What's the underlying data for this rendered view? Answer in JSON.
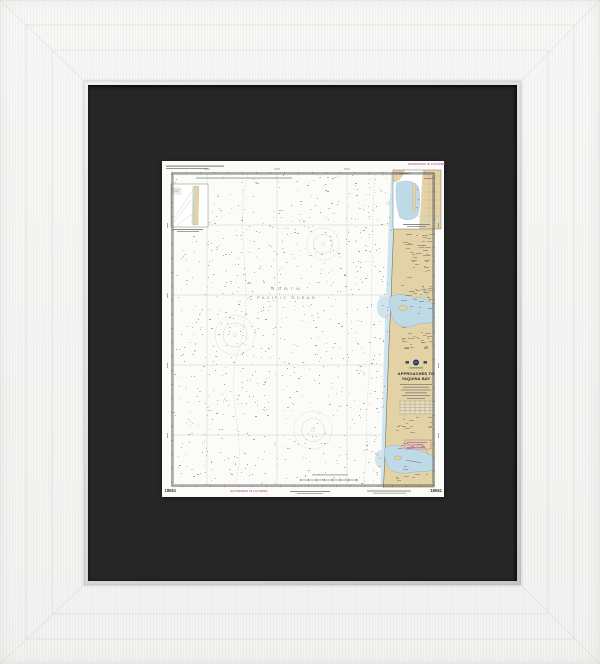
{
  "artwork": {
    "kind": "framed nautical chart print",
    "frame": {
      "color": "#f6f6f5",
      "mat_color": "#262627",
      "lip_light": "#f0f0ef",
      "lip_dark": "#c5c5c3"
    },
    "chart": {
      "number": "18561",
      "title_lines": [
        "APPROACHES TO",
        "YAQUINA BAY"
      ],
      "ocean_label_lines": [
        "NORTH",
        "PACIFIC OCEAN"
      ],
      "soundings_label": "SOUNDINGS IN FATHOMS",
      "colors": {
        "paper": "#fbfbf8",
        "land": "#e2d2a6",
        "shallow_water": "#cde3ec",
        "bay_water": "#bedae6",
        "magenta": "#b95f9e",
        "sounding_dot": "#8f93a0",
        "neatline": "#4c4c4a"
      },
      "texture": {
        "seed": 11,
        "sounding_dot_count": 820,
        "land_speck_count": 130,
        "magenta_speck_count": 22
      }
    }
  }
}
